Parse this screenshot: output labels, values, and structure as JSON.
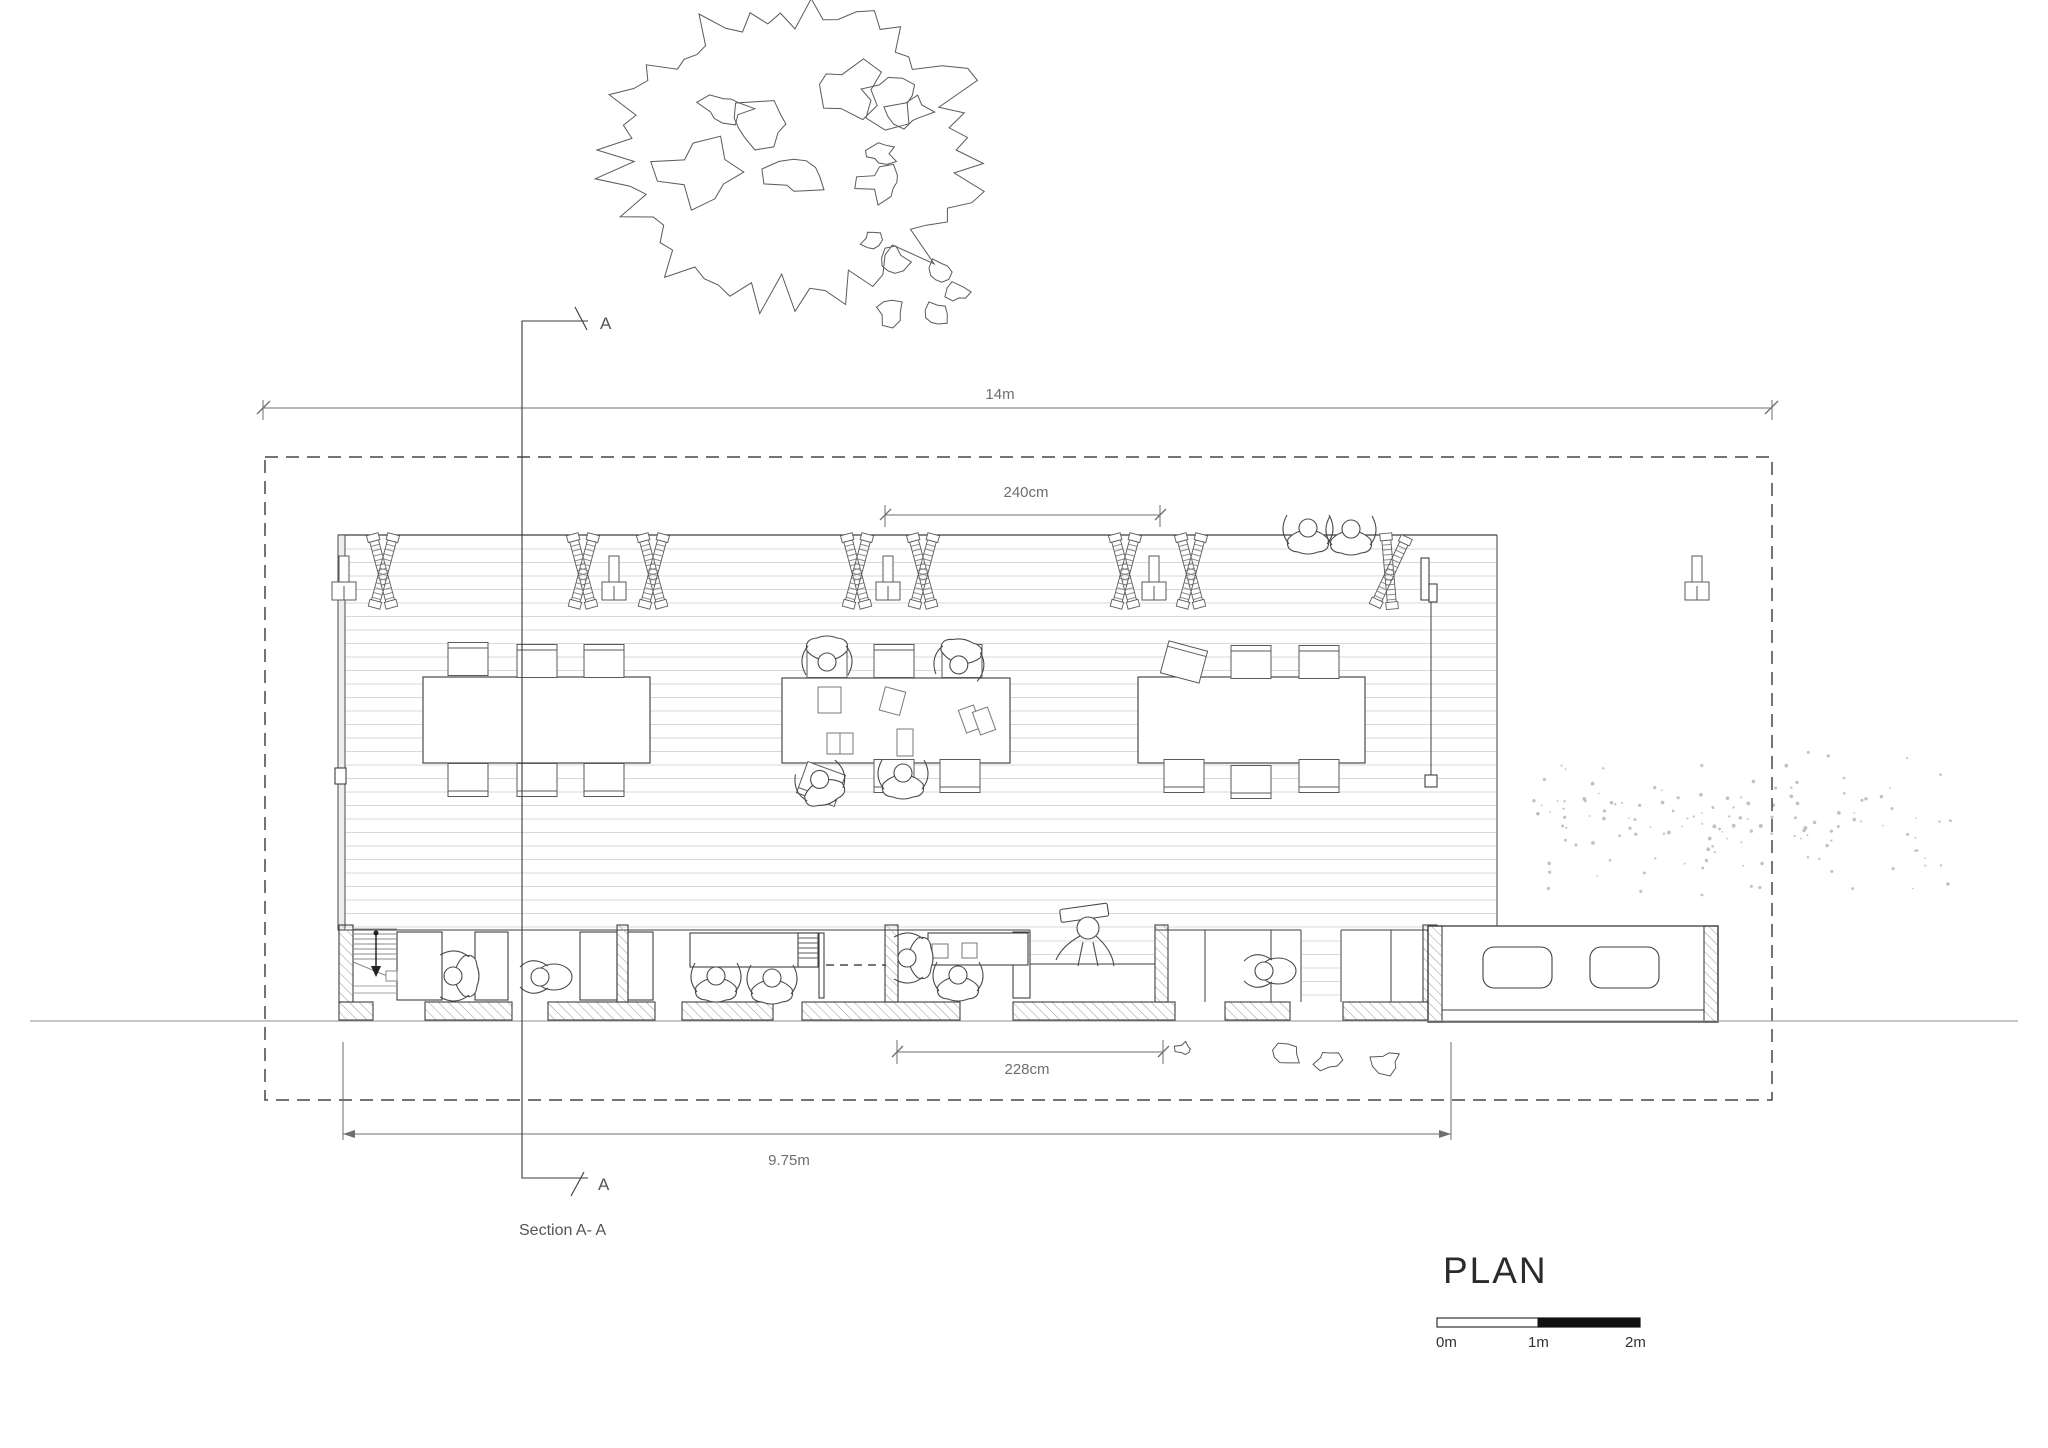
{
  "drawing": {
    "title": "PLAN",
    "section": {
      "marker_top": "A",
      "marker_bottom": "A",
      "caption": "Section A- A"
    },
    "dimensions": {
      "overall": "14m",
      "bay_top": "240cm",
      "bay_bottom": "228cm",
      "building": "9.75m"
    },
    "scale_bar": {
      "zero": "0m",
      "one": "1m",
      "two": "2m"
    }
  },
  "theme": {
    "ink": "#3f3f3f",
    "dim": "#6e6e6e",
    "plank": "#d8d8d8",
    "hatch": "#9a9a9a",
    "scatter": "#b3b3b3",
    "text": "#2b2b2b"
  }
}
